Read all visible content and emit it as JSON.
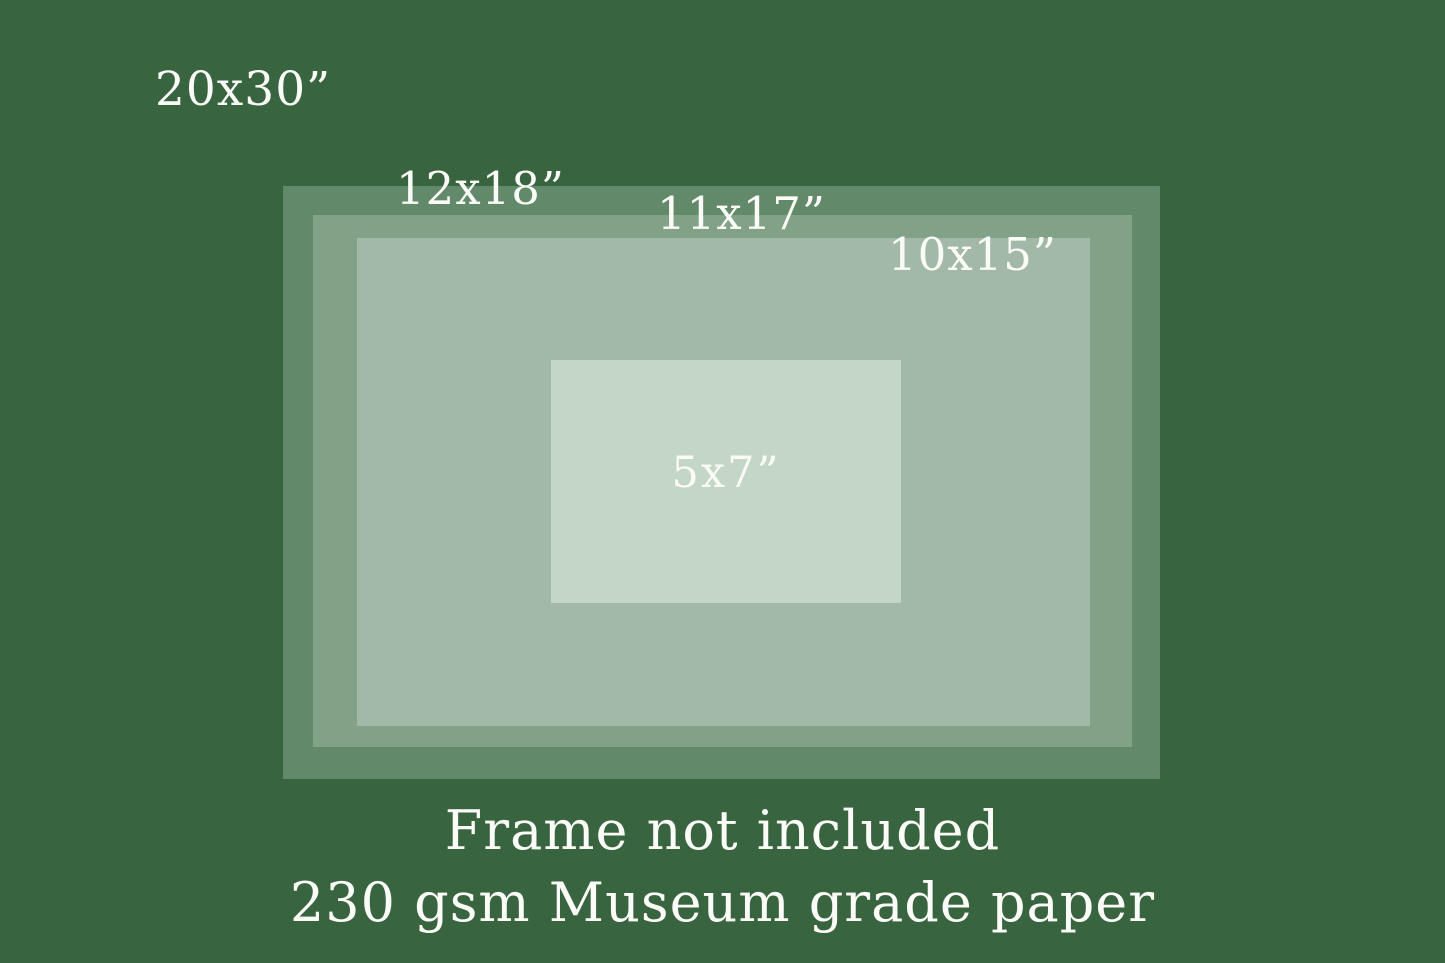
{
  "palette": {
    "background": "#386540",
    "band_12x18": "#62896A",
    "band_11x17": "#81A287",
    "band_10x15": "#A3B9A7",
    "band_5x7": "#C4D6C6",
    "text": "#FAFAF7"
  },
  "sizes": [
    {
      "label": "20x30”",
      "color": "#386540"
    },
    {
      "label": "12x18”",
      "color": "#62896A"
    },
    {
      "label": "11x17”",
      "color": "#81A287"
    },
    {
      "label": "10x15”",
      "color": "#A3B9A7"
    },
    {
      "label": "5x7”",
      "color": "#C4D6C6"
    }
  ],
  "footer": {
    "line1": "Frame not included",
    "line2": "230 gsm Museum grade paper"
  }
}
